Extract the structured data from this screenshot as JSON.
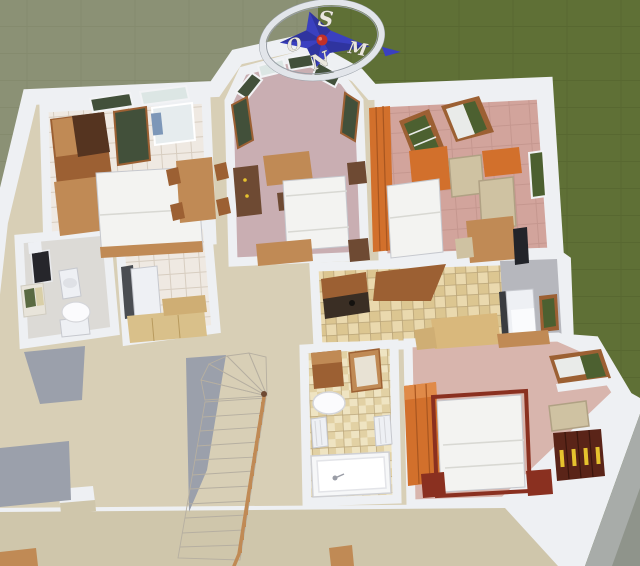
{
  "compass": {
    "labels": {
      "top": "S",
      "left": "O",
      "bottom": "N",
      "right": "M"
    }
  },
  "colors": {
    "grass_left": "#8b9175",
    "grass_left_line": "#7f8668",
    "grass_right": "#5f7036",
    "grass_right_line": "#52622c",
    "wall": "#eef0f3",
    "wall_shade": "#9ba0ab",
    "wall_face": "#a8aca9",
    "wall_corner": "#8f948b",
    "hall_floor": "#d8cfb6",
    "terrace_floor": "#cfc6ab",
    "floor_pink": "#c9aeb2",
    "floor_salmon": "#d2a49c",
    "floor_salmon_line": "#c2948c",
    "floor_bedroom": "#d8b5ad",
    "floor_wc": "#dcdad6",
    "tile_white": "#efe9e2",
    "tile_white_line": "#d7cdc0",
    "tile_beige": "#ead9ae",
    "tile_beige_b": "#dcc691",
    "tile_beige_line": "#b9a478",
    "tile_bath": "#efe4c2",
    "tile_bath_b": "#e2d1a4",
    "kitchen_gray": "#b6b7bd",
    "wood": "#c08a55",
    "wood_mid": "#9c6033",
    "wood_dark": "#6e4a33",
    "wood_deep": "#553420",
    "orange": "#d2702c",
    "orange_light": "#e08a48",
    "bed_white": "#f3f3f1",
    "bed_seam": "#d8d8d3",
    "bed_frame_red": "#8a3020",
    "cabinet_maroon": "#5a2418",
    "gold": "#e6c22e",
    "glass_green": "#42503a",
    "glass_light": "#dce6e4",
    "plant_green": "#4c6030",
    "white_obj": "#eef0f4",
    "obj_stroke": "#c6c8ce",
    "gray_obj": "#9a9da6",
    "dark_obj": "#22242a",
    "blue_accent": "#7d97b8",
    "beige_chair": "#cfc2a2",
    "chair_stroke": "#b0a184",
    "step": "#e8e2d6",
    "step_alt": "#ded8cb",
    "step_line": "#b6afa1",
    "table_beige": "#d9b87c",
    "compass_blue": "#3a40c0",
    "compass_blue_dark": "#2b2f92",
    "compass_ring": "#e2e5ea",
    "compass_rim": "#9aa0a8",
    "compass_red": "#c23028",
    "letter_fill": "#eae7de"
  }
}
